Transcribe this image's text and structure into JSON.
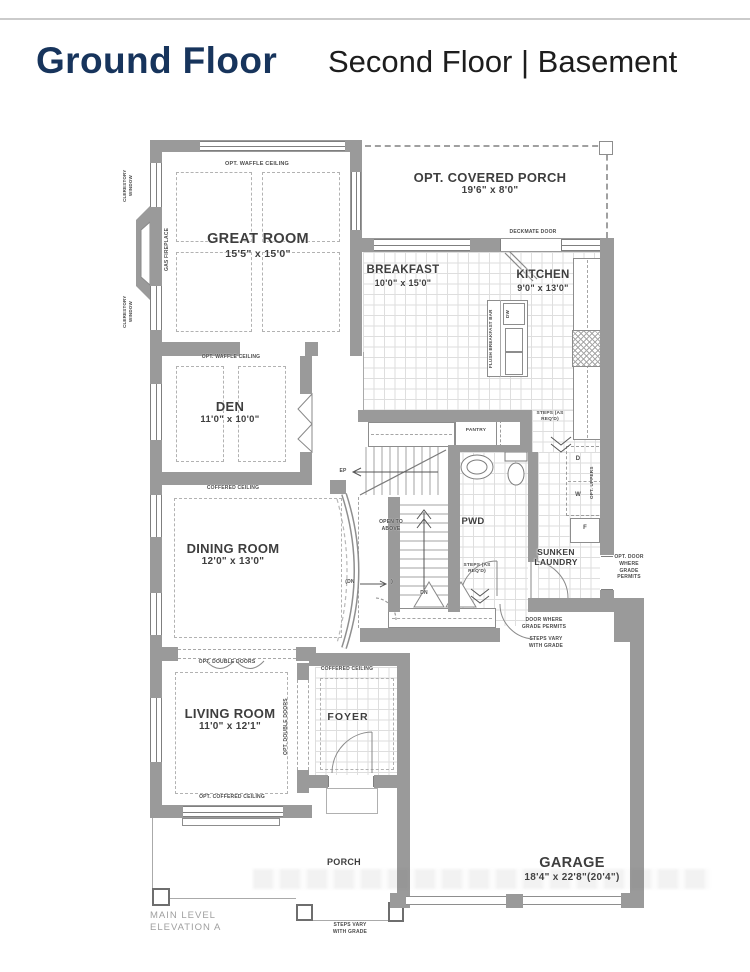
{
  "header": {
    "title": "Ground Floor",
    "subtitle": "Second Floor | Basement"
  },
  "rooms": {
    "great_room": {
      "name": "GREAT ROOM",
      "dims": "15'5\" x 15'0\""
    },
    "covered_porch": {
      "name": "OPT. COVERED PORCH",
      "dims": "19'6\" x 8'0\""
    },
    "breakfast": {
      "name": "BREAKFAST",
      "dims": "10'0\" x 15'0\""
    },
    "kitchen": {
      "name": "KITCHEN",
      "dims": "9'0\" x 13'0\""
    },
    "den": {
      "name": "DEN",
      "dims": "11'0\" x 10'0\""
    },
    "dining_room": {
      "name": "DINING ROOM",
      "dims": "12'0\" x 13'0\""
    },
    "living_room": {
      "name": "LIVING ROOM",
      "dims": "11'0\" x 12'1\""
    },
    "foyer": {
      "name": "FOYER"
    },
    "powder_room": {
      "name": "PWD"
    },
    "sunken_laundry": {
      "name": "SUNKEN LAUNDRY"
    },
    "pantry": {
      "name": "PANTRY"
    },
    "garage": {
      "name": "GARAGE",
      "dims": "18'4\" x 22'8\"(20'4\")"
    },
    "porch": {
      "name": "PORCH"
    }
  },
  "notes": {
    "opt_waffle_ceiling": "OPT. WAFFLE CEILING",
    "coffered_ceiling": "COFFERED CEILING",
    "opt_coffered_ceiling": "OPT. COFFERED CEILING",
    "opt_double_doors": "OPT. DOUBLE DOORS",
    "clerestory_window": "CLERESTORY WINDOW",
    "gas_fireplace": "GAS FIREPLACE",
    "deckmate_door": "DECKMATE DOOR",
    "flush_breakfast_bar": "FLUSH BREAKFAST BAR",
    "opt_uppers": "OPT. UPPERS",
    "steps_as_reqd": "STEPS (AS REQ'D)",
    "open_to_above": "OPEN TO ABOVE",
    "door_where_grade_permits": "DOOR WHERE GRADE PERMITS",
    "opt_door_where_grade_permits": "OPT. DOOR WHERE GRADE PERMITS",
    "steps_vary_with_grade": "STEPS VARY WITH GRADE",
    "ep": "EP",
    "dn": "DN",
    "dn_paren": "(DN",
    "paren_close": ")",
    "dw": "DW",
    "d": "D",
    "w": "W",
    "f": "F"
  },
  "footer": {
    "main_level": "MAIN LEVEL",
    "elevation": "ELEVATION A"
  },
  "colors": {
    "title_accent": "#17345c",
    "wall_gray": "#9a9a9a"
  }
}
